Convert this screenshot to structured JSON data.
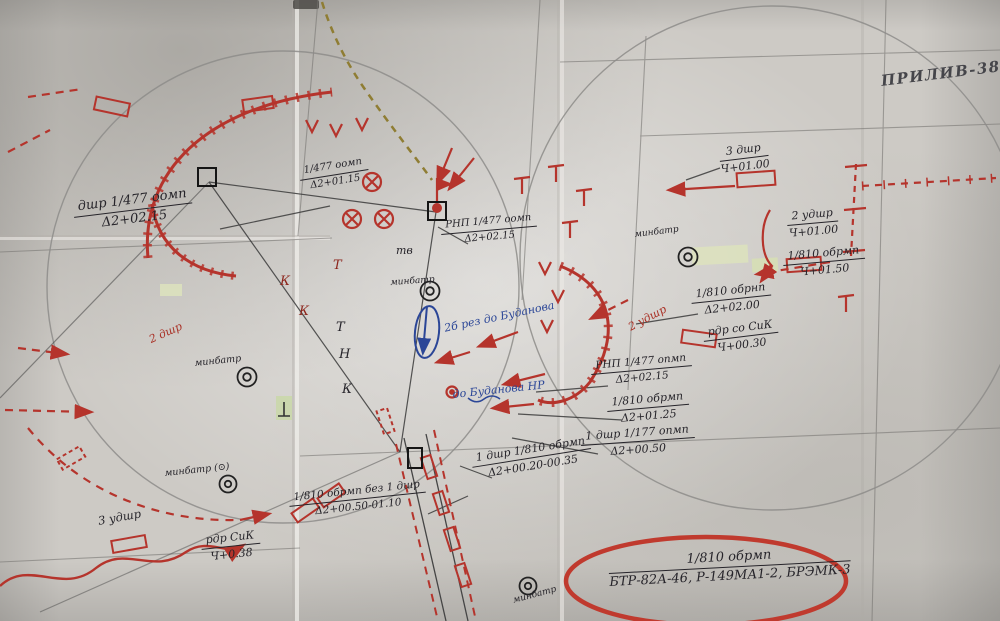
{
  "title": {
    "text": "ПРИЛИВ-3827"
  },
  "colors": {
    "red": "#b5342c",
    "blue": "#2b4697",
    "ink": "#26242a",
    "paper": "#cdcac5",
    "green_patch": "#dde3bd"
  },
  "annotations": [
    {
      "top": "дшр 1/477 оомп",
      "bottom": "Δ2+02.15"
    },
    {
      "top": "1/477 оомп",
      "bottom": "Δ2+01.15"
    },
    {
      "top": "РНП 1/477 оомп",
      "bottom": "Δ2+02.15"
    },
    {
      "top": "3 дшр",
      "bottom": "Ч+01.00"
    },
    {
      "top": "2 удшр",
      "bottom": "Ч+01.00"
    },
    {
      "top": "1/810 обрмп",
      "bottom": "Ч+01.50"
    },
    {
      "top": "1/810 обрнп",
      "bottom": "Δ2+02.00"
    },
    {
      "top": "рдр со СиК",
      "bottom": "Ч+00.30"
    },
    {
      "top": "РНП 1/477 опмп",
      "bottom": "Δ2+02.15"
    },
    {
      "top": "1/810 обрмп",
      "bottom": "Δ2+01.25"
    },
    {
      "top": "1 дшр 1/177 опмп",
      "bottom": "Δ2+00.50"
    },
    {
      "top": "1 дшр 1/810 обрмп",
      "bottom": "Δ2+00.20-00.35"
    },
    {
      "top": "1/810 обрмп без 1 дшр",
      "bottom": "Δ2+00.50-01.10"
    },
    {
      "top": "рдр СиК",
      "bottom": "Ч+0.38"
    },
    {
      "top": "1/810 обрмп",
      "bottom": "БТР-82А-46, Р-149МА1-2, БРЭМК-3"
    }
  ],
  "labels": [
    {
      "text": "минбатр"
    },
    {
      "text": "минбатр"
    },
    {
      "text": "минбатр"
    },
    {
      "text": "минбатр (⊙)"
    },
    {
      "text": "тв"
    },
    {
      "text": "2 дшр"
    },
    {
      "text": "2 удшр"
    },
    {
      "text": "3 удшр"
    },
    {
      "text": "минбатр"
    },
    {
      "text": "Т"
    },
    {
      "text": "К"
    },
    {
      "text": "К"
    },
    {
      "text": "Т"
    },
    {
      "text": "Н"
    },
    {
      "text": "К"
    }
  ],
  "blue_notes": [
    {
      "text": "2б рез до Буданова"
    },
    {
      "text": "до Буданова НР"
    }
  ]
}
